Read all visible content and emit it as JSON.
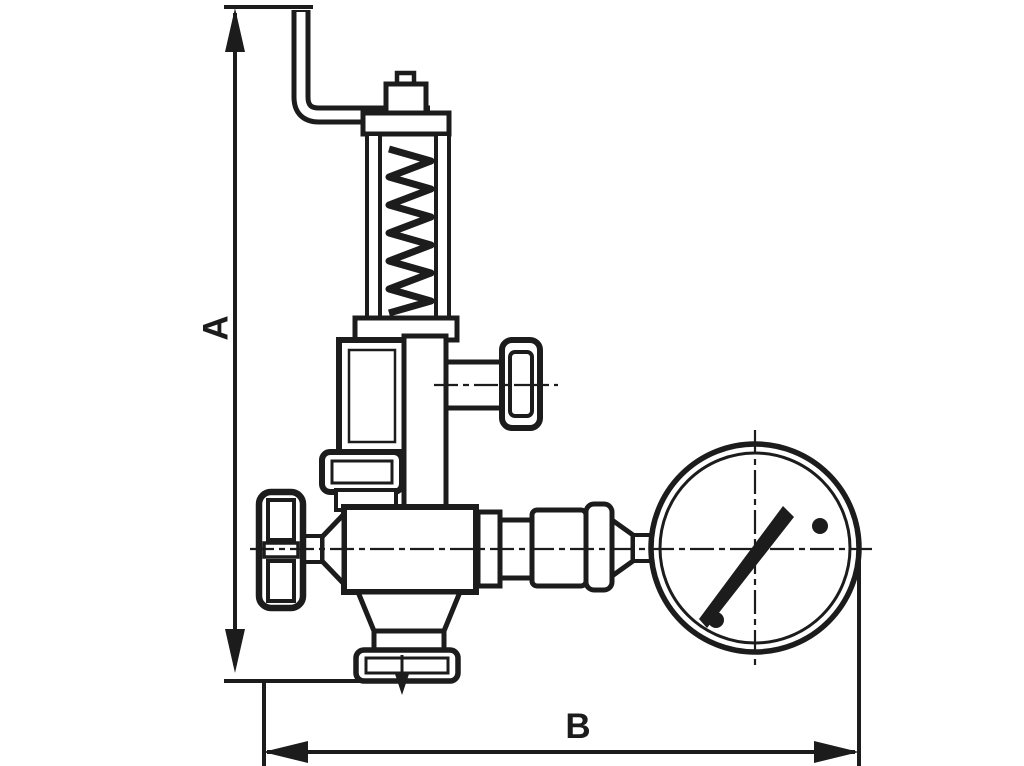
{
  "page": {
    "background_color": "#ffffff"
  },
  "diagram": {
    "type": "technical-line-drawing",
    "subject": "Dimensioned outline drawing of a spring-loaded safety valve with test lever, shut-off handwheels, union fittings and pressure gauge",
    "ink_color": "#1c1c1c",
    "dimensions": [
      {
        "label": "A",
        "orientation": "vertical",
        "measures": "overall height"
      },
      {
        "label": "B",
        "orientation": "horizontal",
        "measures": "overall width"
      }
    ],
    "components": [
      "test-lever",
      "spindle-cap",
      "spring-bonnet",
      "spring-coil",
      "gauge-shutoff-handwheel",
      "inlet-shutoff-handwheel",
      "valve-body",
      "outlet-flange",
      "flow-direction-arrow",
      "union-fittings",
      "pressure-gauge",
      "gauge-needle"
    ]
  }
}
